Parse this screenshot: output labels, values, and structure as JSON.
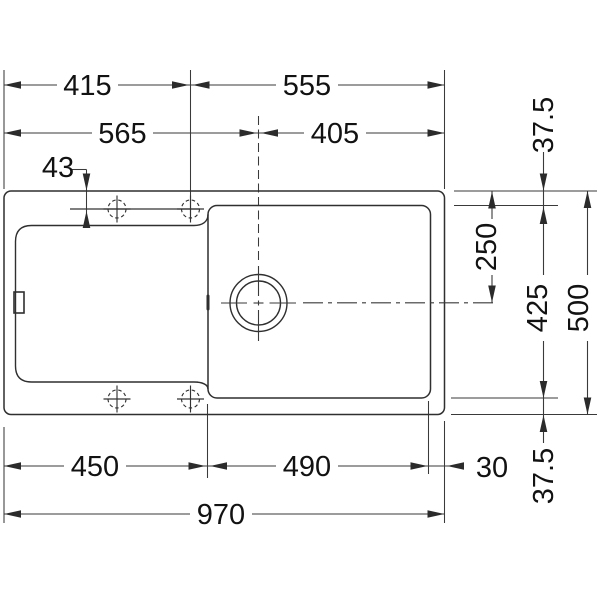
{
  "drawing": {
    "subject": "sink-top-view-technical-drawing",
    "background": "#ffffff",
    "line_color": "#2f2f2f",
    "text_color": "#121212",
    "labels": {
      "width_to_holes": "415",
      "holes_to_right": "555",
      "left_to_drain": "565",
      "drain_to_right": "405",
      "edge_to_holes": "43",
      "top_rim": "37.5",
      "top_to_drain": "250",
      "inner_height": "425",
      "total_height": "500",
      "bottom_rim": "37.5",
      "left_to_bowl": "450",
      "bowl_width": "490",
      "right_rim": "30",
      "total_width": "970"
    }
  }
}
